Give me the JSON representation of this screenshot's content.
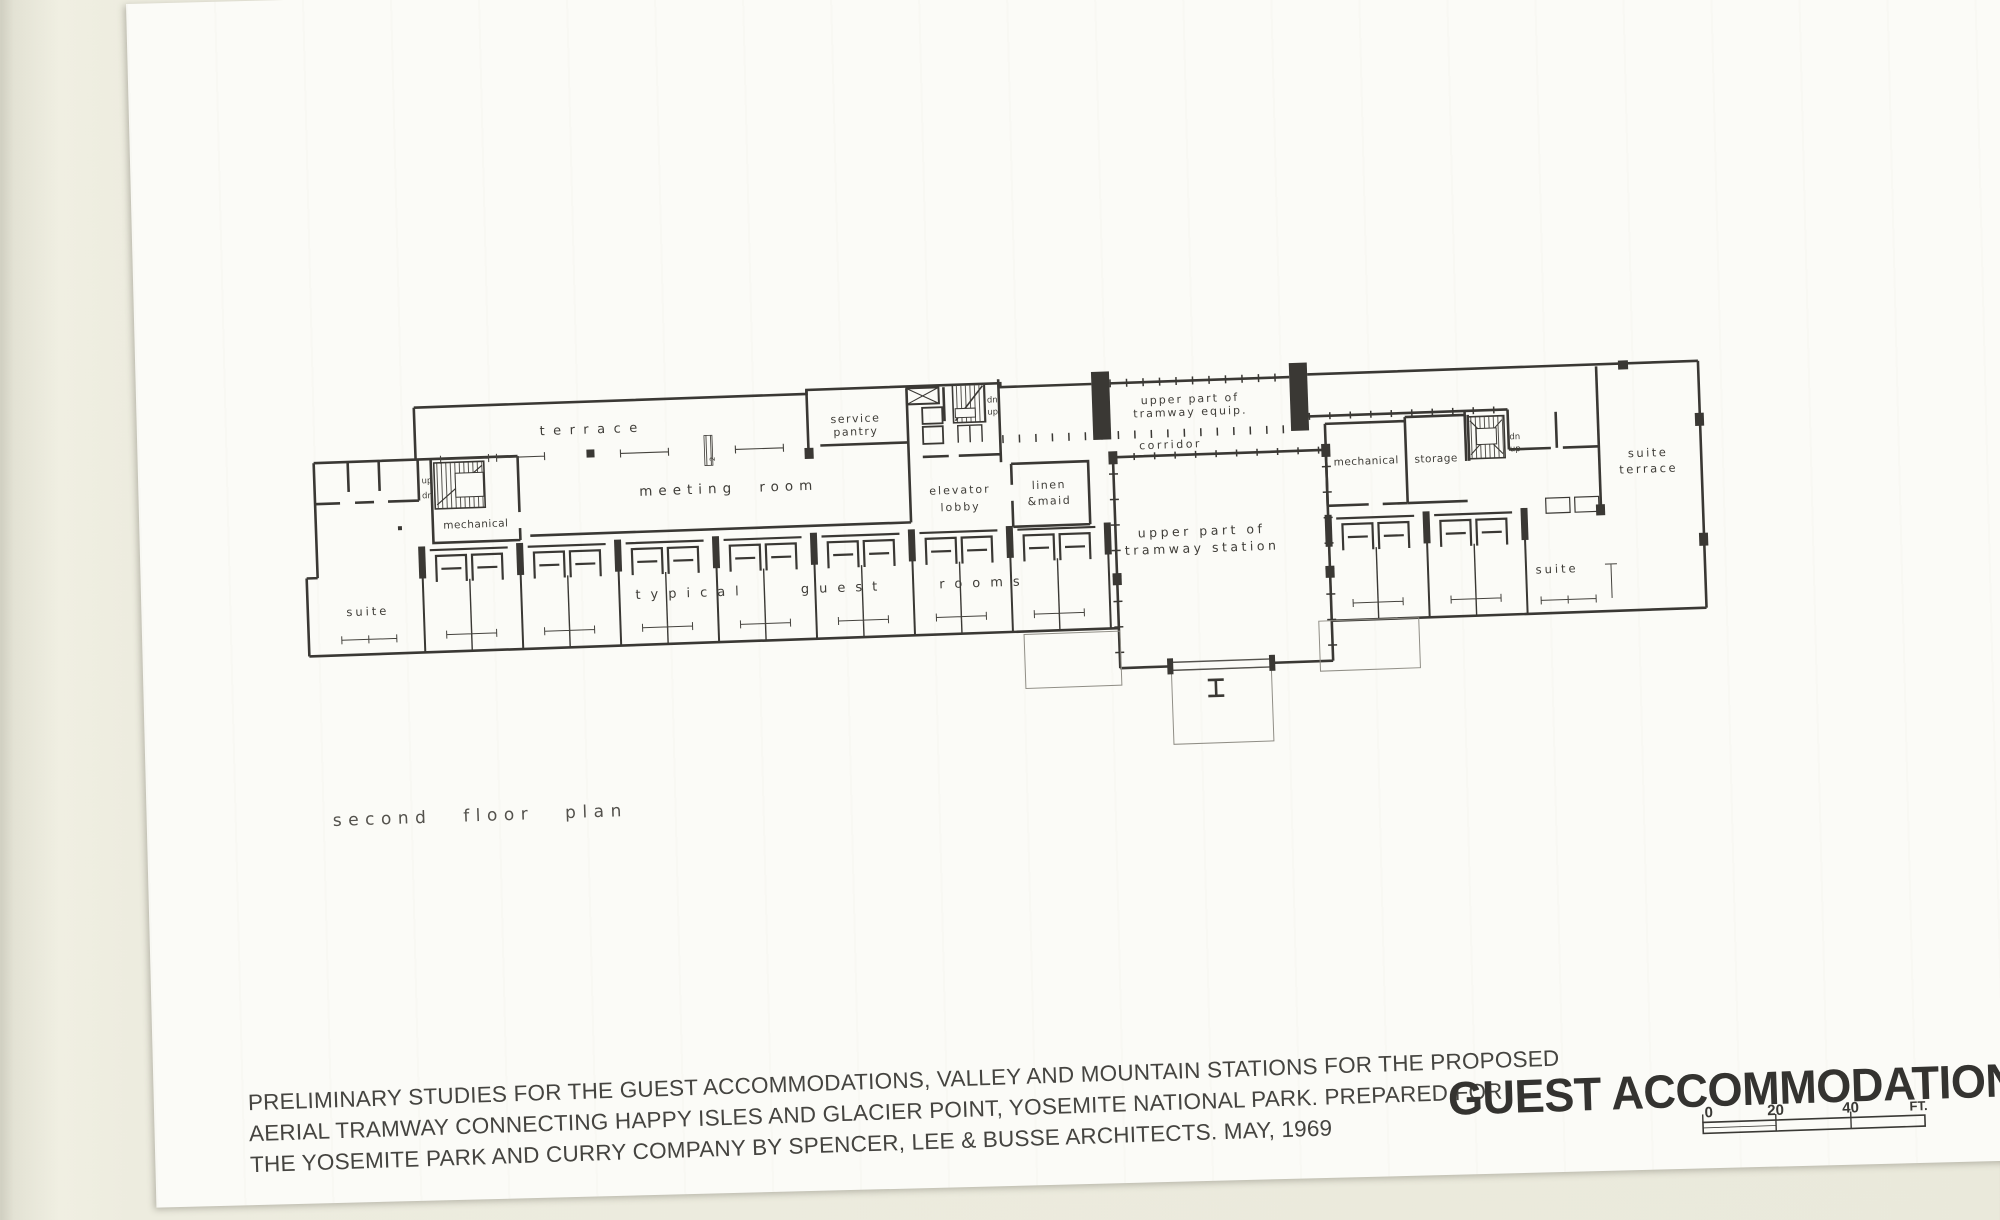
{
  "plan": {
    "caption": "second floor plan",
    "section_marker": "2",
    "labels": {
      "terrace": "terrace",
      "meeting_room": "meeting room",
      "service_pantry_1": "service",
      "service_pantry_2": "pantry",
      "elevator_lobby_1": "elevator",
      "elevator_lobby_2": "lobby",
      "linen_1": "linen",
      "linen_2": "&maid",
      "tramway_equip_1": "upper part of",
      "tramway_equip_2": "tramway equip.",
      "corridor": "corridor",
      "tramway_station_1": "upper part of",
      "tramway_station_2": "tramway station",
      "mechanical_left": "mechanical",
      "mechanical_right": "mechanical",
      "storage": "storage",
      "suite_left": "suite",
      "suite_right": "suite",
      "suite_terrace_1": "suite",
      "suite_terrace_2": "terrace",
      "typical_guest_rooms": "typical guest rooms",
      "stair_left_up": "up",
      "stair_left_dn": "dn",
      "stair_mid_dn": "dn",
      "stair_mid_up": "up",
      "stair_right_dn": "dn",
      "stair_right_up": "up"
    }
  },
  "footer": {
    "description_lines": [
      "PRELIMINARY STUDIES FOR THE GUEST ACCOMMODATIONS, VALLEY AND MOUNTAIN STATIONS FOR THE PROPOSED",
      "AERIAL TRAMWAY CONNECTING HAPPY ISLES AND GLACIER POINT, YOSEMITE NATIONAL PARK.  PREPARED FOR",
      "THE YOSEMITE PARK AND CURRY COMPANY BY SPENCER, LEE & BUSSE ARCHITECTS.   MAY, 1969"
    ],
    "title": "GUEST ACCOMMODATIONS",
    "scale": {
      "zero": "0",
      "twenty": "20",
      "forty": "40",
      "unit": "FT."
    }
  }
}
